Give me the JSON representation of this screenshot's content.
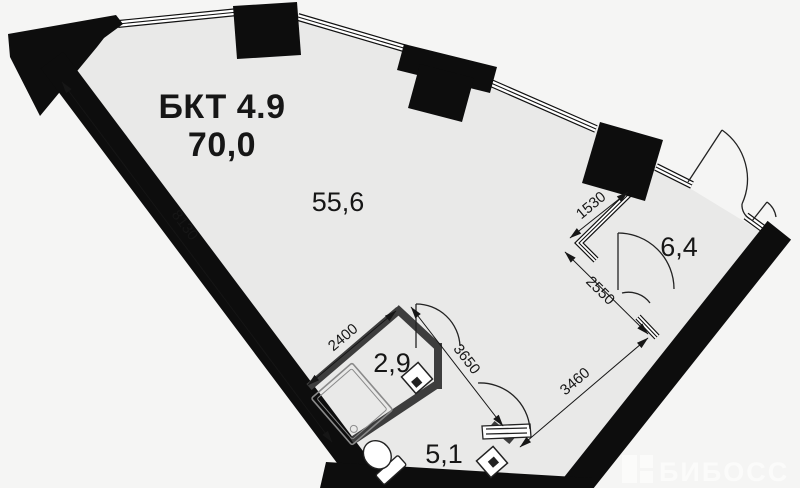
{
  "plan": {
    "unit_label": "БКТ 4.9",
    "total_area": "70,0",
    "rooms": [
      {
        "id": "main-room",
        "area": "55,6"
      },
      {
        "id": "bathroom",
        "area": "2,9"
      },
      {
        "id": "hall",
        "area": "5,1"
      },
      {
        "id": "right-room",
        "area": "6,4"
      }
    ],
    "dimensions": {
      "left_wall": "8130",
      "bathroom_wall": "2400",
      "corridor_wall": "3650",
      "right_room_depth": "2550",
      "right_room_window": "1530",
      "bottom_wall": "3460"
    },
    "colors": {
      "background": "#f5f5f4",
      "floor": "#e9e9e8",
      "wall": "#0d0d0d",
      "partition": "#3d3d3d",
      "line": "#1a1a1a"
    }
  },
  "watermark": {
    "text": "БИБОСС"
  }
}
